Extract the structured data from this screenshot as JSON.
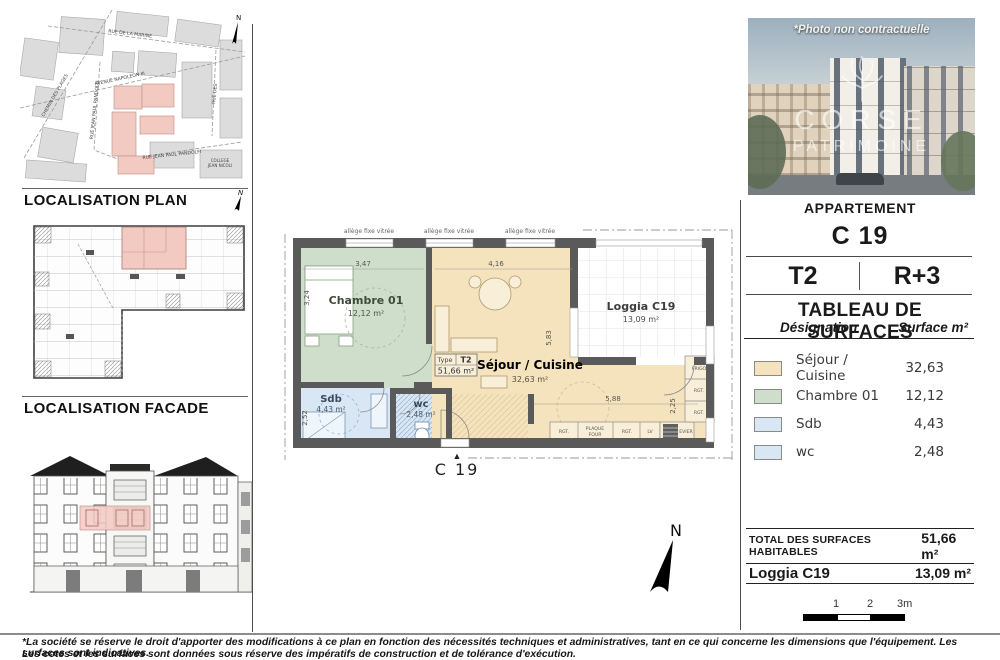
{
  "left": {
    "plan_title": "LOCALISATION PLAN",
    "facade_title": "LOCALISATION FACADE",
    "map": {
      "north": "N",
      "streets": {
        "marine": "RUE DE LA MARINE",
        "napoleon": "AVENUE NAPOLEON III",
        "pandolfi_v": "RUE JEAN PAUL PANDOLFI",
        "plages": "CHEMIN DES PLAGES",
        "pandolfi_b": "RUE JEAN PAUL PANDOLFI",
        "des": "RUE DES"
      },
      "college_1": "COLLEGE",
      "college_2": "JEAN NICOLI"
    }
  },
  "photo": {
    "caption": "*Photo non contractuelle",
    "brand_top": "CORSE",
    "brand_bottom": "PATRIMOINE"
  },
  "panel": {
    "apartment_label": "APPARTEMENT",
    "unit": "C 19",
    "type": "T2",
    "floor": "R+3",
    "table_title": "TABLEAU DE SURFACES",
    "col_designation": "Désignation",
    "col_surface": "Surface m²",
    "rows": [
      {
        "label": "Séjour / Cuisine",
        "value": "32,63",
        "color": "#f5e3bd"
      },
      {
        "label": "Chambre 01",
        "value": "12,12",
        "color": "#cfdecb"
      },
      {
        "label": "Sdb",
        "value": "4,43",
        "color": "#d9e6f3"
      },
      {
        "label": "wc",
        "value": "2,48",
        "color": "#d9e6f3"
      }
    ],
    "total_label": "TOTAL DES SURFACES HABITABLES",
    "total_value": "51,66 m²",
    "loggia_label": "Loggia C19",
    "loggia_value": "13,09 m²",
    "scale": {
      "l1": "1",
      "l2": "2",
      "l3": "3m"
    }
  },
  "plan": {
    "window_labels": [
      "allège fixe vitrée",
      "allège fixe vitrée",
      "allège fixe vitrée"
    ],
    "rooms": {
      "chambre": {
        "name": "Chambre 01",
        "area": "12,12 m²"
      },
      "sejour": {
        "name": "Séjour / Cuisine",
        "area": "32,63 m²"
      },
      "loggia": {
        "name": "Loggia C19",
        "area": "13,09 m²"
      },
      "sdb": {
        "name": "Sdb",
        "area": "4,43 m²"
      },
      "wc": {
        "name": "wc",
        "area": "2,48 m²"
      }
    },
    "type_box": {
      "label": "Type",
      "type": "T2",
      "area": "51,66 m²"
    },
    "dims": {
      "chambre_w": "3,47",
      "chambre_h": "3,24",
      "sejour_w": "4,16",
      "sejour_h": "5,83",
      "sdb_h": "2,52",
      "kitchen_w": "5,88",
      "kitchen_h": "2,25"
    },
    "kitchen": {
      "frigo": "FRIGO",
      "rgt_a": "RGT.",
      "rgt_b": "RGT.",
      "rgt_c": "RGT.",
      "plaque_1": "PLAQUE",
      "plaque_2": "FOUR",
      "rgt_d": "RGT.",
      "lv": "LV",
      "evier": "EVIER"
    },
    "entrance_label": "C 19",
    "north_letter": "N"
  },
  "footer": {
    "line1": "*La société se réserve le droit d'apporter des modifications à ce plan en fonction des nécessités techniques et administratives, tant en ce qui concerne les dimensions que l'équipement. Les surfaces sont indicatives.",
    "line2": "Les cotes et les surfaces sont données sous réserve des impératifs de construction et de tolérance d'exécution."
  }
}
